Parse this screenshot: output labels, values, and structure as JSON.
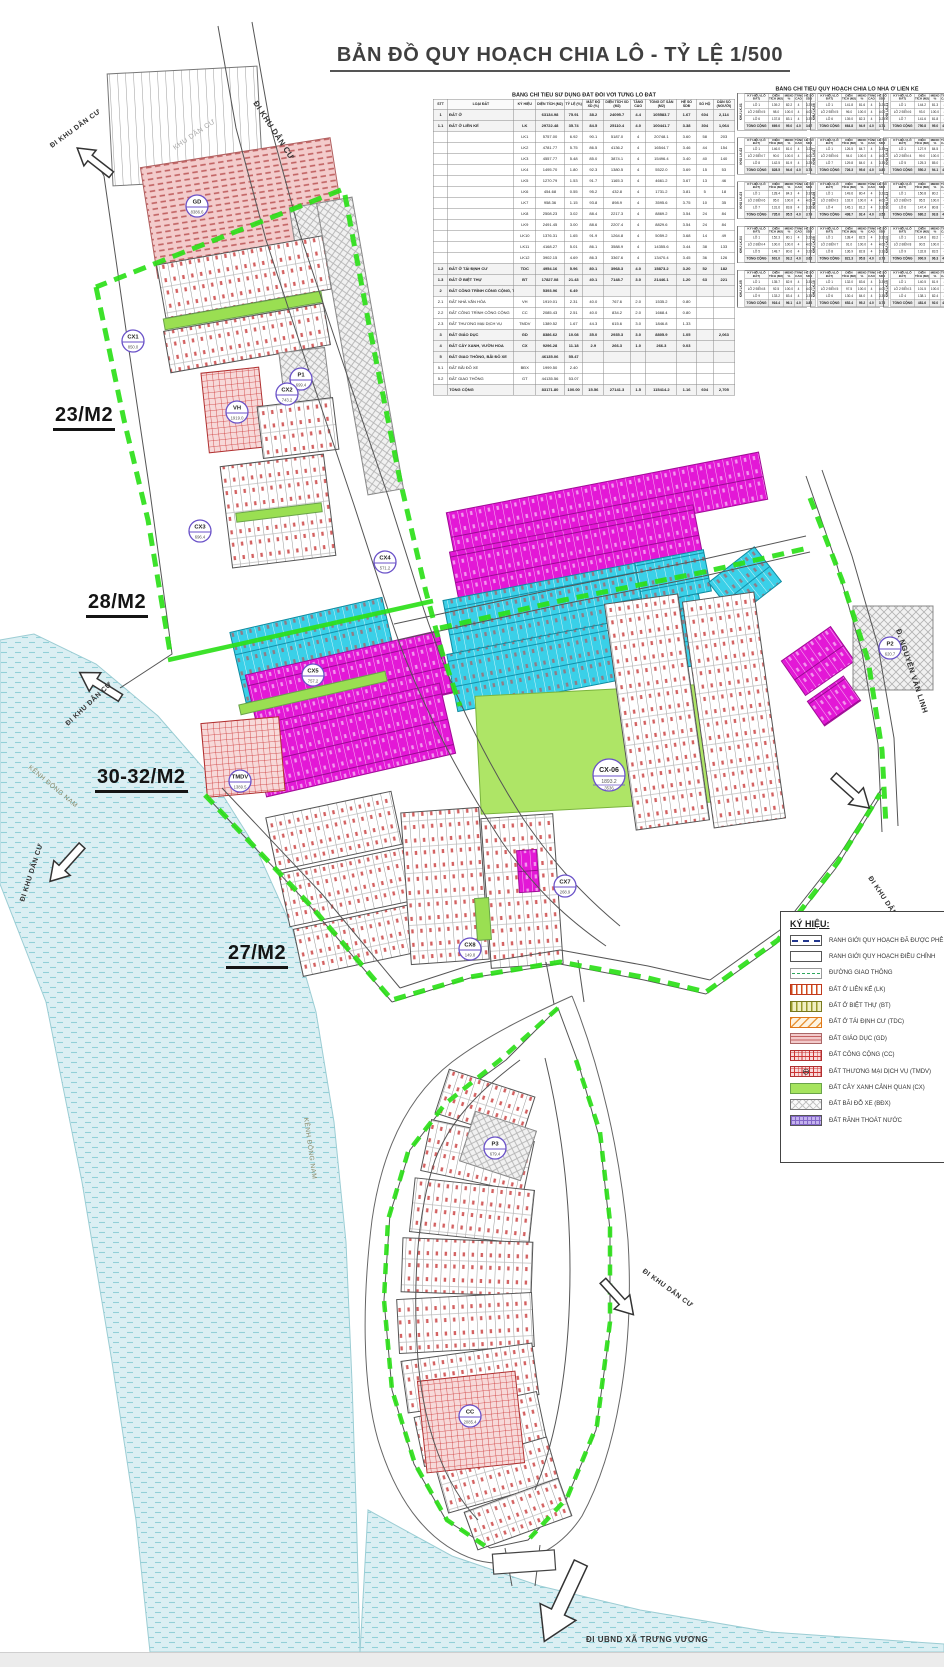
{
  "page": {
    "title": "BẢN ĐỒ QUY HOẠCH CHIA LÔ - TỶ LỆ 1/500"
  },
  "sheet_labels": [
    {
      "text": "23/M2",
      "x": 53,
      "y": 404
    },
    {
      "text": "28/M2",
      "x": 86,
      "y": 591
    },
    {
      "text": "30-32/M2",
      "x": 95,
      "y": 766
    },
    {
      "text": "27/M2",
      "x": 226,
      "y": 942
    }
  ],
  "map": {
    "road_labels": [
      {
        "text": "ĐI KHU DÂN CƯ",
        "x": 253,
        "y": 103,
        "rot": 57,
        "size": 8,
        "bold": true,
        "color": "#333333"
      },
      {
        "text": "KHU DÂN CƯ",
        "x": 175,
        "y": 150,
        "rot": -34,
        "size": 7,
        "bold": false,
        "color": "#a8a8a8"
      },
      {
        "text": "ĐI KHU DÂN CƯ",
        "x": 52,
        "y": 148,
        "rot": -36,
        "size": 7,
        "bold": true,
        "color": "#333333"
      },
      {
        "text": "ĐI KHU DÂN CƯ",
        "x": 68,
        "y": 726,
        "rot": -43,
        "size": 7,
        "bold": true,
        "color": "#333333"
      },
      {
        "text": "KÊNH ĐÔNG NAM",
        "x": 28,
        "y": 768,
        "rot": 40,
        "size": 6.5,
        "bold": false,
        "color": "#8a8a6a"
      },
      {
        "text": "ĐI KHU DÂN CƯ",
        "x": 24,
        "y": 902,
        "rot": -72,
        "size": 7,
        "bold": true,
        "color": "#333333"
      },
      {
        "text": "KÊNH ĐÔNG NAM",
        "x": 304,
        "y": 1118,
        "rot": 82,
        "size": 6.5,
        "bold": false,
        "color": "#8a8a6a"
      },
      {
        "text": "Đ. NGUYỄN VĂN LINH",
        "x": 896,
        "y": 630,
        "rot": 72,
        "size": 7.5,
        "bold": true,
        "color": "#333333"
      },
      {
        "text": "ĐI KHU DÂN CƯ",
        "x": 868,
        "y": 878,
        "rot": 56,
        "size": 7,
        "bold": true,
        "color": "#333333"
      },
      {
        "text": "ĐI KHU DÂN CƯ",
        "x": 642,
        "y": 1272,
        "rot": 36,
        "size": 7,
        "bold": true,
        "color": "#333333"
      },
      {
        "text": "ĐI UBND XÃ TRƯNG VƯƠNG",
        "x": 586,
        "y": 1642,
        "rot": 0,
        "size": 8,
        "bold": true,
        "color": "#333333"
      }
    ],
    "zone_markers": [
      {
        "code": "GD",
        "area": "8386.6",
        "x": 197,
        "y": 206,
        "big": false
      },
      {
        "code": "CX1",
        "area": "850.0",
        "x": 133,
        "y": 341,
        "big": false
      },
      {
        "code": "P1",
        "area": "699.4",
        "x": 301,
        "y": 379,
        "big": false
      },
      {
        "code": "VH",
        "area": "1919.0",
        "x": 237,
        "y": 412,
        "big": false
      },
      {
        "code": "CX2",
        "area": "743.2",
        "x": 287,
        "y": 394,
        "big": false
      },
      {
        "code": "CX3",
        "area": "696.4",
        "x": 200,
        "y": 531,
        "big": false
      },
      {
        "code": "CX4",
        "area": "571.2",
        "x": 385,
        "y": 562,
        "big": false
      },
      {
        "code": "CX5",
        "area": "757.2",
        "x": 313,
        "y": 675,
        "big": false
      },
      {
        "code": "TMDV",
        "area": "1389.5",
        "x": 240,
        "y": 781,
        "big": false
      },
      {
        "code": "CX-06",
        "area": "1893.2",
        "area2": "3536",
        "x": 609,
        "y": 775,
        "big": true
      },
      {
        "code": "P2",
        "area": "620.7",
        "x": 890,
        "y": 648,
        "big": false
      },
      {
        "code": "CX7",
        "area": "268.9",
        "x": 565,
        "y": 886,
        "big": false
      },
      {
        "code": "CX8",
        "area": "149.8",
        "x": 470,
        "y": 949,
        "big": false
      },
      {
        "code": "P3",
        "area": "679.4",
        "x": 495,
        "y": 1148,
        "big": false
      },
      {
        "code": "CC",
        "area": "2085.4",
        "x": 470,
        "y": 1416,
        "big": false
      }
    ]
  },
  "table1": {
    "title": "BẢNG CHỈ TIÊU SỬ DỤNG ĐẤT ĐỐI VỚI TỪNG LÔ ĐẤT",
    "columns": [
      "STT",
      "LOẠI ĐẤT",
      "KÝ HIỆU",
      "DIỆN TÍCH (M2)",
      "TỶ LỆ (%)",
      "MẬT ĐỘ XD (%)",
      "DIỆN TÍCH XD (M2)",
      "TẦNG CAO",
      "TỔNG DT SÀN (M2)",
      "HỆ SỐ SDĐ",
      "SỐ HỘ",
      "DÂN SỐ (NGƯỜI)"
    ],
    "rows": [
      [
        "1",
        "ĐẤT Ở",
        "",
        "63134.98",
        "75.91",
        "38.2",
        "24095.7",
        "4.4",
        "105583.7",
        "1.67",
        "604",
        "2,114"
      ],
      [
        "1.1",
        "ĐẤT Ở LIÊN KẾ",
        "LK",
        "29722.48",
        "35.74",
        "84.5",
        "25110.4",
        "4.0",
        "100441.7",
        "3.38",
        "304",
        "1,064"
      ],
      [
        "",
        "",
        "LK1",
        "5757.00",
        "6.92",
        "90.1",
        "5187.0",
        "4",
        "20748.1",
        "3.60",
        "58",
        "203"
      ],
      [
        "",
        "",
        "LK2",
        "4781.77",
        "5.75",
        "86.5",
        "4136.2",
        "4",
        "16544.7",
        "3.46",
        "44",
        "154"
      ],
      [
        "",
        "",
        "LK3",
        "4557.77",
        "5.48",
        "85.0",
        "3874.1",
        "4",
        "15496.4",
        "3.40",
        "40",
        "140"
      ],
      [
        "",
        "",
        "LK4",
        "1495.70",
        "1.80",
        "92.3",
        "1380.5",
        "4",
        "5522.0",
        "3.69",
        "15",
        "53"
      ],
      [
        "",
        "",
        "LK5",
        "1270.79",
        "1.53",
        "91.7",
        "1165.3",
        "4",
        "4661.2",
        "3.67",
        "13",
        "46"
      ],
      [
        "",
        "",
        "LK6",
        "454.68",
        "0.55",
        "95.2",
        "432.8",
        "4",
        "1731.2",
        "3.81",
        "5",
        "18"
      ],
      [
        "",
        "",
        "LK7",
        "958.36",
        "1.15",
        "93.8",
        "898.9",
        "4",
        "3595.6",
        "3.75",
        "10",
        "35"
      ],
      [
        "",
        "",
        "LK8",
        "2508.23",
        "3.02",
        "88.4",
        "2217.3",
        "4",
        "8869.2",
        "3.54",
        "24",
        "84"
      ],
      [
        "",
        "",
        "LK9",
        "2491.45",
        "3.00",
        "88.6",
        "2207.4",
        "4",
        "8829.6",
        "3.54",
        "24",
        "84"
      ],
      [
        "",
        "",
        "LK10",
        "1376.31",
        "1.65",
        "91.9",
        "1264.8",
        "4",
        "5059.2",
        "3.68",
        "14",
        "49"
      ],
      [
        "",
        "",
        "LK11",
        "4168.27",
        "5.01",
        "86.1",
        "3588.9",
        "4",
        "14355.6",
        "3.44",
        "38",
        "133"
      ],
      [
        "",
        "",
        "LK12",
        "3902.15",
        "4.69",
        "86.3",
        "3367.6",
        "4",
        "13470.4",
        "3.45",
        "36",
        "126"
      ],
      [
        "1.2",
        "ĐẤT Ở TÁI ĐỊNH CƯ",
        "TDC",
        "4954.16",
        "5.96",
        "80.1",
        "3968.3",
        "4.0",
        "15873.2",
        "3.20",
        "52",
        "182"
      ],
      [
        "1.3",
        "ĐẤT Ở BIỆT THỰ",
        "BT",
        "17827.08",
        "21.43",
        "40.1",
        "7148.7",
        "3.0",
        "21446.1",
        "1.20",
        "63",
        "221"
      ],
      [
        "2",
        "ĐẤT CÔNG TRÌNH CÔNG CỘNG, THƯƠNG MẠI DỊCH VỤ",
        "",
        "5393.96",
        "6.49",
        "",
        "",
        "",
        "",
        "",
        "",
        ""
      ],
      [
        "2.1",
        "ĐẤT NHÀ VĂN HÓA",
        "VH",
        "1919.01",
        "2.31",
        "40.0",
        "767.6",
        "2.0",
        "1535.2",
        "0.80",
        "",
        ""
      ],
      [
        "2.2",
        "ĐẤT CÔNG TRÌNH CÔNG CỘNG",
        "CC",
        "2085.43",
        "2.51",
        "40.0",
        "834.2",
        "2.0",
        "1668.4",
        "0.80",
        "",
        ""
      ],
      [
        "2.3",
        "ĐẤT THƯƠNG MẠI DỊCH VỤ",
        "TMDV",
        "1389.52",
        "1.67",
        "44.3",
        "615.6",
        "3.0",
        "1846.8",
        "1.33",
        "",
        ""
      ],
      [
        "3",
        "ĐẤT GIÁO DỤC",
        "GD",
        "8386.62",
        "10.08",
        "35.0",
        "2935.3",
        "3.0",
        "8805.9",
        "1.05",
        "",
        "2,063"
      ],
      [
        "4",
        "ĐẤT CÂY XANH, VƯỜN HOA",
        "CX",
        "9296.28",
        "11.18",
        "2.9",
        "266.3",
        "1.0",
        "266.3",
        "0.03",
        "",
        ""
      ],
      [
        "5",
        "ĐẤT GIAO THÔNG, BÃI ĐỖ XE",
        "",
        "46135.06",
        "55.47",
        "",
        "",
        "",
        "",
        "",
        "",
        ""
      ],
      [
        "5.1",
        "ĐẤT BÃI ĐỖ XE",
        "BĐX",
        "1999.50",
        "2.40",
        "",
        "",
        "",
        "",
        "",
        "",
        ""
      ],
      [
        "5.2",
        "ĐẤT GIAO THÔNG",
        "GT",
        "44135.56",
        "53.07",
        "",
        "",
        "",
        "",
        "",
        "",
        ""
      ],
      [
        "",
        "TỔNG CỘNG",
        "",
        "83171.80",
        "100.00",
        "15.56",
        "27141.3",
        "1.5",
        "115414.2",
        "1.16",
        "604",
        "2,705"
      ]
    ],
    "bold_rows": [
      0,
      1,
      14,
      15,
      16,
      20,
      21,
      22,
      25
    ]
  },
  "table2": {
    "title": "BẢNG CHỈ TIÊU QUY HOẠCH CHIA LÔ NHÀ Ở LIÊN KẾ",
    "khu_prefix": "KHU",
    "columns": [
      "KÝ HIỆU (LÔ ĐẤT)",
      "DIỆN TÍCH (M2)",
      "MĐXD %",
      "TẦNG CAO",
      "HỆ SỐ SDĐ"
    ],
    "groups": [
      {
        "khu": "LK-01",
        "rows": [
          [
            "LÔ 1",
            "139.2",
            "82.2",
            "4",
            "3.29"
          ],
          [
            "LÔ 2 ĐẾN 5",
            "98.0",
            "100.0",
            "4",
            "4.00"
          ],
          [
            "LÔ 6",
            "137.8",
            "83.1",
            "4",
            "3.32"
          ]
        ],
        "total": [
          "TỔNG CỘNG",
          "669.0",
          "95.0",
          "4.0",
          "3.67"
        ]
      },
      {
        "khu": "LK-02",
        "rows": [
          [
            "LÔ 1",
            "146.0",
            "81.0",
            "4",
            "3.24"
          ],
          [
            "LÔ 2 ĐẾN 7",
            "90.0",
            "100.0",
            "4",
            "4.00"
          ],
          [
            "LÔ 8",
            "142.5",
            "81.9",
            "4",
            "3.28"
          ]
        ],
        "total": [
          "TỔNG CỘNG",
          "828.5",
          "94.6",
          "4.0",
          "3.74"
        ]
      },
      {
        "khu": "LK-03",
        "rows": [
          [
            "LÔ 1",
            "128.4",
            "84.3",
            "4",
            "3.37"
          ],
          [
            "LÔ 2 ĐẾN 6",
            "95.0",
            "100.0",
            "4",
            "4.00"
          ],
          [
            "LÔ 7",
            "131.6",
            "83.8",
            "4",
            "3.35"
          ]
        ],
        "total": [
          "TỔNG CỘNG",
          "735.0",
          "95.5",
          "4.0",
          "3.79"
        ]
      },
      {
        "khu": "LK-04",
        "rows": [
          [
            "LÔ 1",
            "152.3",
            "80.1",
            "4",
            "3.20"
          ],
          [
            "LÔ 2 ĐẾN 4",
            "100.0",
            "100.0",
            "4",
            "4.00"
          ],
          [
            "LÔ 5",
            "148.7",
            "80.6",
            "4",
            "3.22"
          ]
        ],
        "total": [
          "TỔNG CỘNG",
          "601.0",
          "93.2",
          "4.0",
          "3.62"
        ]
      },
      {
        "khu": "LK-05",
        "rows": [
          [
            "LÔ 1",
            "135.7",
            "82.9",
            "4",
            "3.31"
          ],
          [
            "LÔ 2 ĐẾN 8",
            "92.5",
            "100.0",
            "4",
            "4.00"
          ],
          [
            "LÔ 9",
            "133.2",
            "83.4",
            "4",
            "3.33"
          ]
        ],
        "total": [
          "TỔNG CỘNG",
          "916.4",
          "96.1",
          "4.0",
          "3.82"
        ]
      },
      {
        "khu": "LK-06",
        "rows": [
          [
            "LÔ 1",
            "141.8",
            "81.6",
            "4",
            "3.26"
          ],
          [
            "LÔ 2 ĐẾN 5",
            "96.0",
            "100.0",
            "4",
            "4.00"
          ],
          [
            "LÔ 6",
            "139.0",
            "82.3",
            "4",
            "3.29"
          ]
        ],
        "total": [
          "TỔNG CỘNG",
          "664.8",
          "94.9",
          "4.0",
          "3.71"
        ]
      },
      {
        "khu": "LK-07",
        "rows": [
          [
            "LÔ 1",
            "126.5",
            "84.7",
            "4",
            "3.39"
          ],
          [
            "LÔ 2 ĐẾN 6",
            "94.0",
            "100.0",
            "4",
            "4.00"
          ],
          [
            "LÔ 7",
            "129.8",
            "84.0",
            "4",
            "3.36"
          ]
        ],
        "total": [
          "TỔNG CỘNG",
          "726.3",
          "95.6",
          "4.0",
          "3.80"
        ]
      },
      {
        "khu": "LK-08",
        "rows": [
          [
            "LÔ 1",
            "149.6",
            "80.4",
            "4",
            "3.21"
          ],
          [
            "LÔ 2 ĐẾN 3",
            "102.0",
            "100.0",
            "4",
            "4.00"
          ],
          [
            "LÔ 4",
            "145.1",
            "81.2",
            "4",
            "3.25"
          ]
        ],
        "total": [
          "TỔNG CỘNG",
          "498.7",
          "92.4",
          "4.0",
          "3.58"
        ]
      },
      {
        "khu": "LK-09",
        "rows": [
          [
            "LÔ 1",
            "138.4",
            "82.5",
            "4",
            "3.30"
          ],
          [
            "LÔ 2 ĐẾN 7",
            "91.0",
            "100.0",
            "4",
            "4.00"
          ],
          [
            "LÔ 8",
            "136.9",
            "82.8",
            "4",
            "3.31"
          ]
        ],
        "total": [
          "TỔNG CỘNG",
          "821.3",
          "95.8",
          "4.0",
          "3.78"
        ]
      },
      {
        "khu": "LK-10",
        "rows": [
          [
            "LÔ 1",
            "132.0",
            "83.6",
            "4",
            "3.34"
          ],
          [
            "LÔ 2 ĐẾN 5",
            "97.5",
            "100.0",
            "4",
            "4.00"
          ],
          [
            "LÔ 6",
            "130.4",
            "84.0",
            "4",
            "3.36"
          ]
        ],
        "total": [
          "TỔNG CỘNG",
          "652.4",
          "95.2",
          "4.0",
          "3.76"
        ]
      },
      {
        "khu": "LK-11",
        "rows": [
          [
            "LÔ 1",
            "144.2",
            "81.3",
            "4",
            "3.25"
          ],
          [
            "LÔ 2 ĐẾN 6",
            "93.0",
            "100.0",
            "4",
            "4.00"
          ],
          [
            "LÔ 7",
            "141.6",
            "81.8",
            "4",
            "3.27"
          ]
        ],
        "total": [
          "TỔNG CỘNG",
          "750.8",
          "95.0",
          "4.0",
          "3.73"
        ]
      },
      {
        "khu": "LK-12",
        "rows": [
          [
            "LÔ 1",
            "127.9",
            "84.5",
            "4",
            "3.38"
          ],
          [
            "LÔ 2 ĐẾN 4",
            "99.0",
            "100.0",
            "4",
            "4.00"
          ],
          [
            "LÔ 5",
            "125.3",
            "85.0",
            "4",
            "3.40"
          ]
        ],
        "total": [
          "TỔNG CỘNG",
          "550.2",
          "94.1",
          "4.0",
          "3.70"
        ]
      },
      {
        "khu": "LK-13",
        "rows": [
          [
            "LÔ 1",
            "150.8",
            "80.2",
            "4",
            "3.21"
          ],
          [
            "LÔ 2 ĐẾN 5",
            "95.5",
            "100.0",
            "4",
            "4.00"
          ],
          [
            "LÔ 6",
            "147.4",
            "80.8",
            "4",
            "3.23"
          ]
        ],
        "total": [
          "TỔNG CỘNG",
          "680.2",
          "93.8",
          "4.0",
          "3.65"
        ]
      },
      {
        "khu": "LK-14",
        "rows": [
          [
            "LÔ 1",
            "134.6",
            "83.2",
            "4",
            "3.33"
          ],
          [
            "LÔ 2 ĐẾN 8",
            "90.5",
            "100.0",
            "4",
            "4.00"
          ],
          [
            "LÔ 9",
            "132.8",
            "83.5",
            "4",
            "3.34"
          ]
        ],
        "total": [
          "TỔNG CỘNG",
          "900.9",
          "96.3",
          "4.0",
          "3.83"
        ]
      },
      {
        "khu": "LK-15",
        "rows": [
          [
            "LÔ 1",
            "140.5",
            "81.9",
            "4",
            "3.28"
          ],
          [
            "LÔ 2 ĐẾN 3",
            "101.5",
            "100.0",
            "4",
            "4.00"
          ],
          [
            "LÔ 4",
            "138.1",
            "82.4",
            "4",
            "3.30"
          ]
        ],
        "total": [
          "TỔNG CỘNG",
          "481.6",
          "92.0",
          "4.0",
          "3.56"
        ]
      }
    ]
  },
  "legend": {
    "title": "KÝ HIỆU:",
    "items": [
      {
        "key": "approved",
        "label": "RANH GIỚI QUY HOẠCH ĐÃ ĐƯỢC PHÊ DUYỆT"
      },
      {
        "key": "adjusted",
        "label": "RANH GIỚI QUY HOẠCH ĐIỀU CHỈNH"
      },
      {
        "key": "road",
        "label": "ĐƯỜNG GIAO THÔNG"
      },
      {
        "key": "lk",
        "label": "ĐẤT Ở LIÊN KẾ (LK)"
      },
      {
        "key": "bt",
        "label": "ĐẤT Ở BIỆT THỰ (BT)"
      },
      {
        "key": "tdc",
        "label": "ĐẤT Ở TÁI ĐỊNH CƯ (TDC)"
      },
      {
        "key": "gd",
        "label": "ĐẤT GIÁO DỤC (GD)"
      },
      {
        "key": "cc",
        "label": "ĐẤT CÔNG CỘNG (CC)"
      },
      {
        "key": "tmdv",
        "label": "ĐẤT THƯƠNG MẠI DỊCH VỤ (TMDV)",
        "symbol": "⊖"
      },
      {
        "key": "cx",
        "label": "ĐẤT CÂY XANH CẢNH QUAN (CX)"
      },
      {
        "key": "bdx",
        "label": "ĐẤT BÃI ĐỖ XE (BĐX)"
      },
      {
        "key": "drain",
        "label": "ĐẤT RÃNH THOÁT NƯỚC"
      }
    ]
  }
}
